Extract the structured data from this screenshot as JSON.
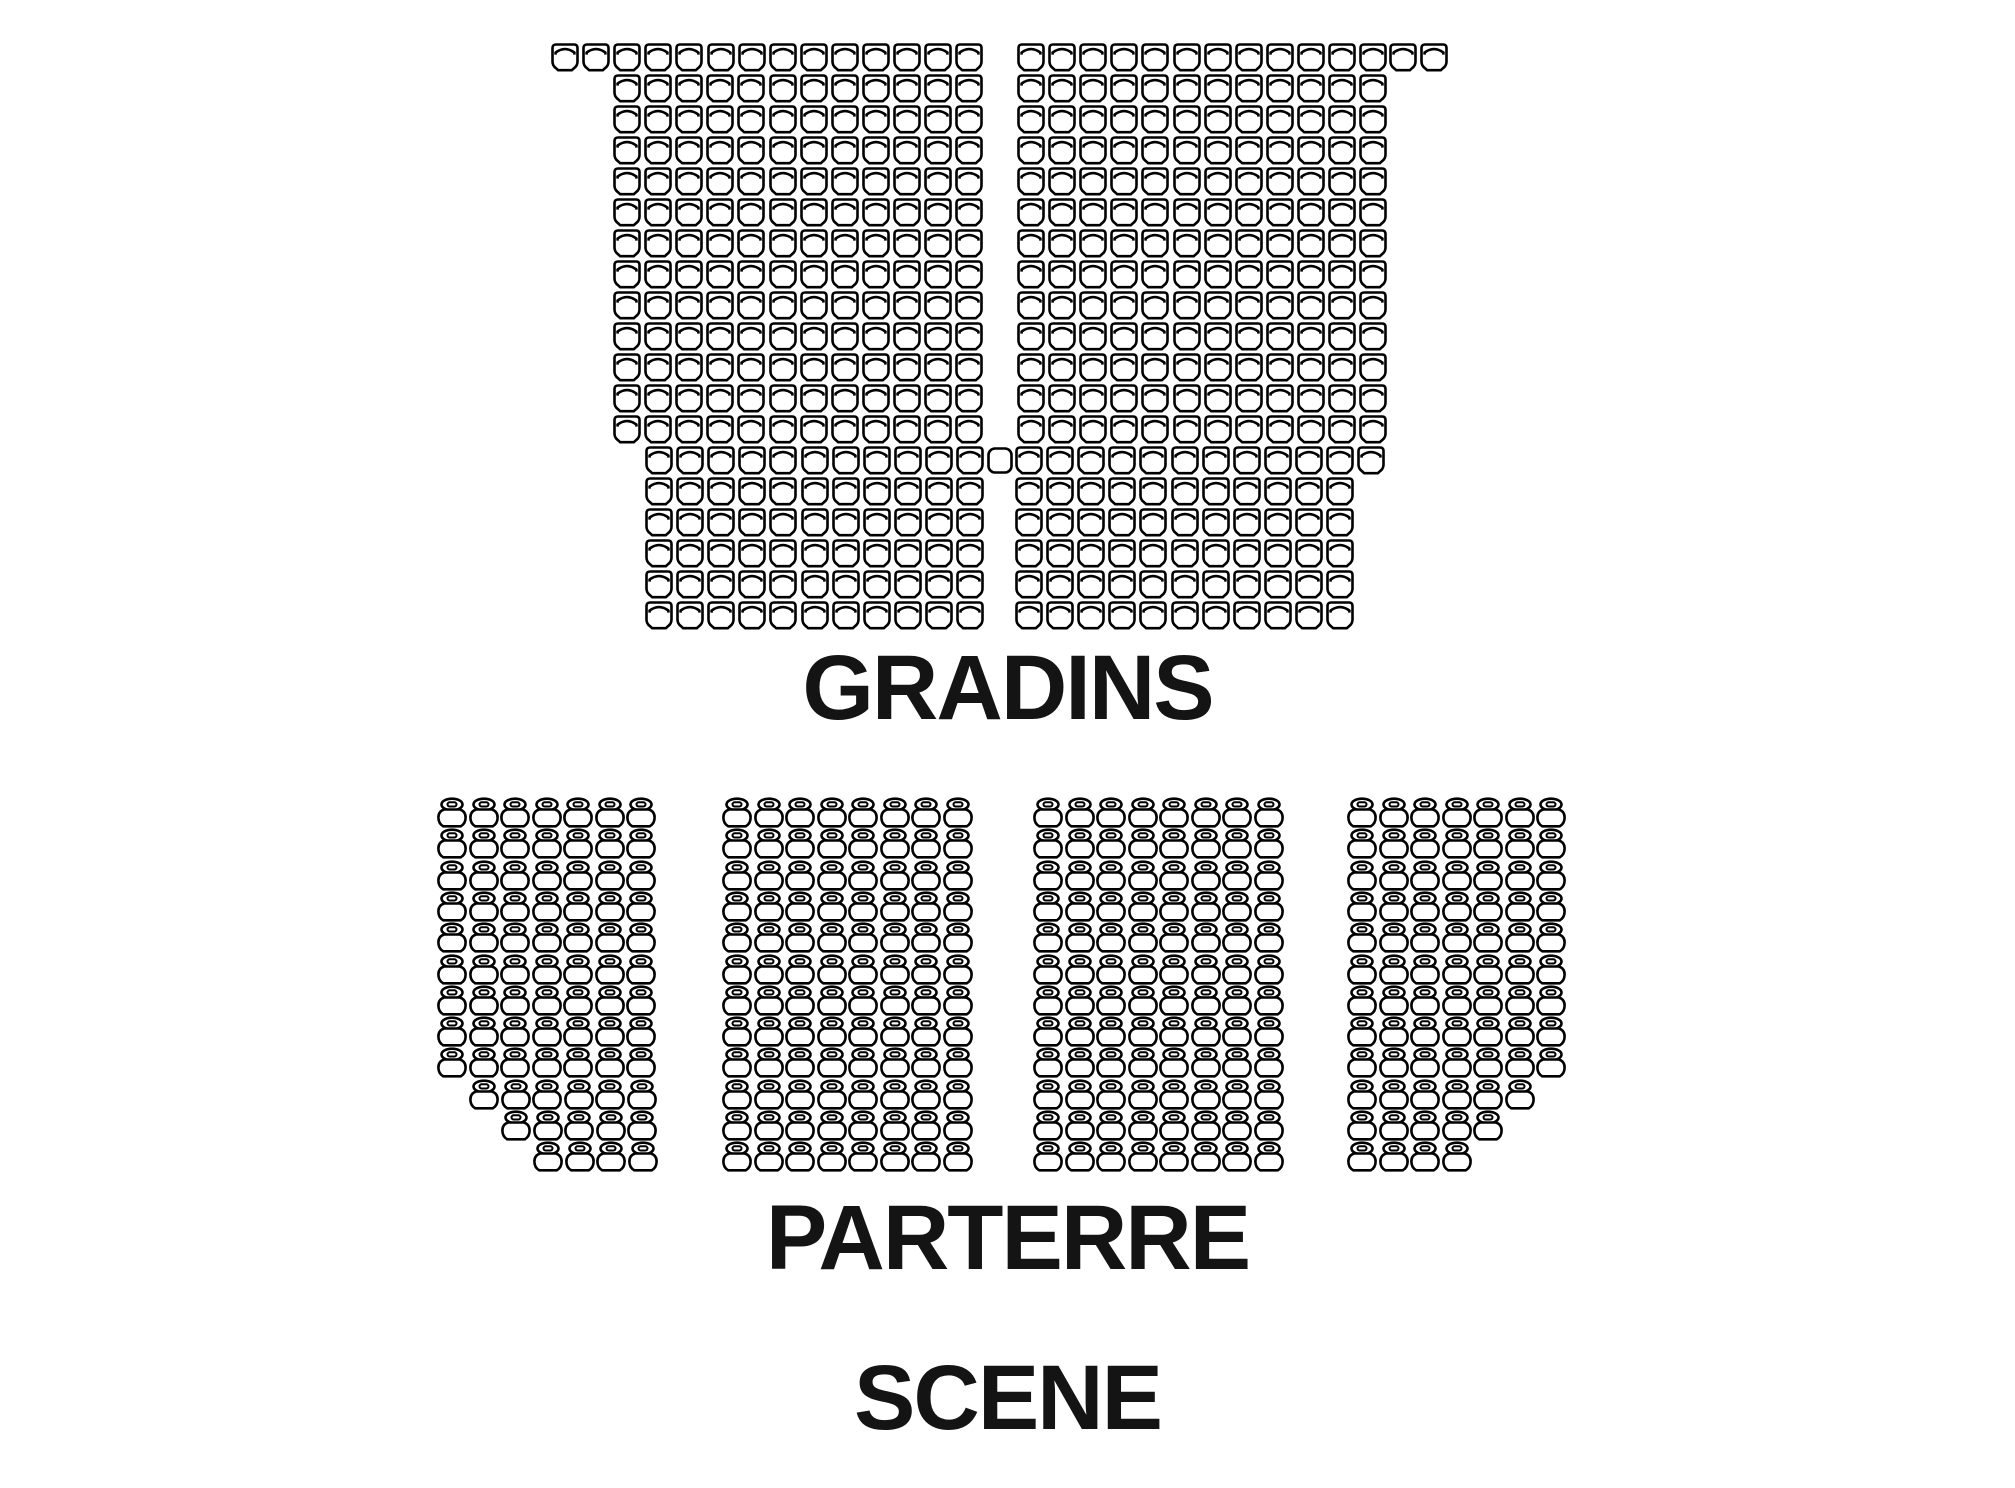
{
  "labels": {
    "gradins": "GRADINS",
    "parterre": "PARTERRE",
    "scene": "SCENE"
  },
  "icons": {
    "gradin": "theater-seat-icon",
    "gradin_plain": "plain-seat-icon",
    "parterre": "chair-seat-icon"
  },
  "seatmap": {
    "seat_color": "#000000",
    "background_color": "#ffffff",
    "total_seats": 798,
    "sections": [
      {
        "name": "gradins",
        "icon": "gradin",
        "seat_count": 450,
        "seat_w": 28,
        "seat_h": 29,
        "pitch_x": 31.1,
        "pitch_y": 31.0,
        "origin_y": 43,
        "rows": [
          {
            "runs": [
              {
                "x": 551,
                "n": 14
              },
              {
                "x": 1017,
                "n": 12
              },
              {
                "x": 1389,
                "n": 2
              }
            ]
          },
          {
            "runs": [
              {
                "x": 613,
                "n": 12
              },
              {
                "x": 1017,
                "n": 12
              }
            ]
          },
          {
            "runs": [
              {
                "x": 613,
                "n": 12
              },
              {
                "x": 1017,
                "n": 12
              }
            ]
          },
          {
            "runs": [
              {
                "x": 613,
                "n": 12
              },
              {
                "x": 1017,
                "n": 12
              }
            ]
          },
          {
            "runs": [
              {
                "x": 613,
                "n": 12
              },
              {
                "x": 1017,
                "n": 12
              }
            ]
          },
          {
            "runs": [
              {
                "x": 613,
                "n": 12
              },
              {
                "x": 1017,
                "n": 12
              }
            ]
          },
          {
            "runs": [
              {
                "x": 613,
                "n": 12
              },
              {
                "x": 1017,
                "n": 12
              }
            ]
          },
          {
            "runs": [
              {
                "x": 613,
                "n": 12
              },
              {
                "x": 1017,
                "n": 12
              }
            ]
          },
          {
            "runs": [
              {
                "x": 613,
                "n": 12
              },
              {
                "x": 1017,
                "n": 12
              }
            ]
          },
          {
            "runs": [
              {
                "x": 613,
                "n": 12
              },
              {
                "x": 1017,
                "n": 12
              }
            ]
          },
          {
            "runs": [
              {
                "x": 613,
                "n": 12
              },
              {
                "x": 1017,
                "n": 12
              }
            ]
          },
          {
            "runs": [
              {
                "x": 613,
                "n": 12
              },
              {
                "x": 1017,
                "n": 12
              }
            ]
          },
          {
            "runs": [
              {
                "x": 613,
                "n": 12
              },
              {
                "x": 1017,
                "n": 12
              }
            ]
          },
          {
            "runs": [
              {
                "x": 645,
                "n": 11
              },
              {
                "x": 986,
                "n": 1,
                "style": "plain"
              },
              {
                "x": 1015,
                "n": 12
              }
            ]
          },
          {
            "runs": [
              {
                "x": 645,
                "n": 11
              },
              {
                "x": 1015,
                "n": 11
              }
            ]
          },
          {
            "runs": [
              {
                "x": 645,
                "n": 11
              },
              {
                "x": 1015,
                "n": 11
              }
            ]
          },
          {
            "runs": [
              {
                "x": 645,
                "n": 11
              },
              {
                "x": 1015,
                "n": 11
              }
            ]
          },
          {
            "runs": [
              {
                "x": 645,
                "n": 11
              },
              {
                "x": 1015,
                "n": 11
              }
            ]
          },
          {
            "runs": [
              {
                "x": 645,
                "n": 11
              },
              {
                "x": 1015,
                "n": 11
              }
            ]
          }
        ]
      },
      {
        "name": "parterre-block-1",
        "icon": "parterre",
        "seat_count": 78,
        "seat_w": 30,
        "seat_h": 31,
        "pitch_x": 31.5,
        "pitch_y": 31.3,
        "origin_y": 797,
        "rows": [
          {
            "runs": [
              {
                "x": 437,
                "n": 7
              }
            ]
          },
          {
            "runs": [
              {
                "x": 437,
                "n": 7
              }
            ]
          },
          {
            "runs": [
              {
                "x": 437,
                "n": 7
              }
            ]
          },
          {
            "runs": [
              {
                "x": 437,
                "n": 7
              }
            ]
          },
          {
            "runs": [
              {
                "x": 437,
                "n": 7
              }
            ]
          },
          {
            "runs": [
              {
                "x": 437,
                "n": 7
              }
            ]
          },
          {
            "runs": [
              {
                "x": 437,
                "n": 7
              }
            ]
          },
          {
            "runs": [
              {
                "x": 437,
                "n": 7
              }
            ]
          },
          {
            "runs": [
              {
                "x": 437,
                "n": 7
              }
            ]
          },
          {
            "runs": [
              {
                "x": 469,
                "n": 6
              }
            ]
          },
          {
            "runs": [
              {
                "x": 501,
                "n": 5
              }
            ]
          },
          {
            "runs": [
              {
                "x": 533,
                "n": 4
              }
            ]
          }
        ]
      },
      {
        "name": "parterre-block-2",
        "icon": "parterre",
        "seat_count": 96,
        "seat_w": 30,
        "seat_h": 31,
        "pitch_x": 31.5,
        "pitch_y": 31.3,
        "origin_y": 797,
        "rows": [
          {
            "runs": [
              {
                "x": 722,
                "n": 8
              }
            ]
          },
          {
            "runs": [
              {
                "x": 722,
                "n": 8
              }
            ]
          },
          {
            "runs": [
              {
                "x": 722,
                "n": 8
              }
            ]
          },
          {
            "runs": [
              {
                "x": 722,
                "n": 8
              }
            ]
          },
          {
            "runs": [
              {
                "x": 722,
                "n": 8
              }
            ]
          },
          {
            "runs": [
              {
                "x": 722,
                "n": 8
              }
            ]
          },
          {
            "runs": [
              {
                "x": 722,
                "n": 8
              }
            ]
          },
          {
            "runs": [
              {
                "x": 722,
                "n": 8
              }
            ]
          },
          {
            "runs": [
              {
                "x": 722,
                "n": 8
              }
            ]
          },
          {
            "runs": [
              {
                "x": 722,
                "n": 8
              }
            ]
          },
          {
            "runs": [
              {
                "x": 722,
                "n": 8
              }
            ]
          },
          {
            "runs": [
              {
                "x": 722,
                "n": 8
              }
            ]
          }
        ]
      },
      {
        "name": "parterre-block-3",
        "icon": "parterre",
        "seat_count": 96,
        "seat_w": 30,
        "seat_h": 31,
        "pitch_x": 31.5,
        "pitch_y": 31.3,
        "origin_y": 797,
        "rows": [
          {
            "runs": [
              {
                "x": 1033,
                "n": 8
              }
            ]
          },
          {
            "runs": [
              {
                "x": 1033,
                "n": 8
              }
            ]
          },
          {
            "runs": [
              {
                "x": 1033,
                "n": 8
              }
            ]
          },
          {
            "runs": [
              {
                "x": 1033,
                "n": 8
              }
            ]
          },
          {
            "runs": [
              {
                "x": 1033,
                "n": 8
              }
            ]
          },
          {
            "runs": [
              {
                "x": 1033,
                "n": 8
              }
            ]
          },
          {
            "runs": [
              {
                "x": 1033,
                "n": 8
              }
            ]
          },
          {
            "runs": [
              {
                "x": 1033,
                "n": 8
              }
            ]
          },
          {
            "runs": [
              {
                "x": 1033,
                "n": 8
              }
            ]
          },
          {
            "runs": [
              {
                "x": 1033,
                "n": 8
              }
            ]
          },
          {
            "runs": [
              {
                "x": 1033,
                "n": 8
              }
            ]
          },
          {
            "runs": [
              {
                "x": 1033,
                "n": 8
              }
            ]
          }
        ]
      },
      {
        "name": "parterre-block-4",
        "icon": "parterre",
        "seat_count": 78,
        "seat_w": 30,
        "seat_h": 31,
        "pitch_x": 31.5,
        "pitch_y": 31.3,
        "origin_y": 797,
        "rows": [
          {
            "runs": [
              {
                "x": 1347,
                "n": 7
              }
            ]
          },
          {
            "runs": [
              {
                "x": 1347,
                "n": 7
              }
            ]
          },
          {
            "runs": [
              {
                "x": 1347,
                "n": 7
              }
            ]
          },
          {
            "runs": [
              {
                "x": 1347,
                "n": 7
              }
            ]
          },
          {
            "runs": [
              {
                "x": 1347,
                "n": 7
              }
            ]
          },
          {
            "runs": [
              {
                "x": 1347,
                "n": 7
              }
            ]
          },
          {
            "runs": [
              {
                "x": 1347,
                "n": 7
              }
            ]
          },
          {
            "runs": [
              {
                "x": 1347,
                "n": 7
              }
            ]
          },
          {
            "runs": [
              {
                "x": 1347,
                "n": 7
              }
            ]
          },
          {
            "runs": [
              {
                "x": 1347,
                "n": 6
              }
            ]
          },
          {
            "runs": [
              {
                "x": 1347,
                "n": 5
              }
            ]
          },
          {
            "runs": [
              {
                "x": 1347,
                "n": 4
              }
            ]
          }
        ]
      }
    ]
  }
}
